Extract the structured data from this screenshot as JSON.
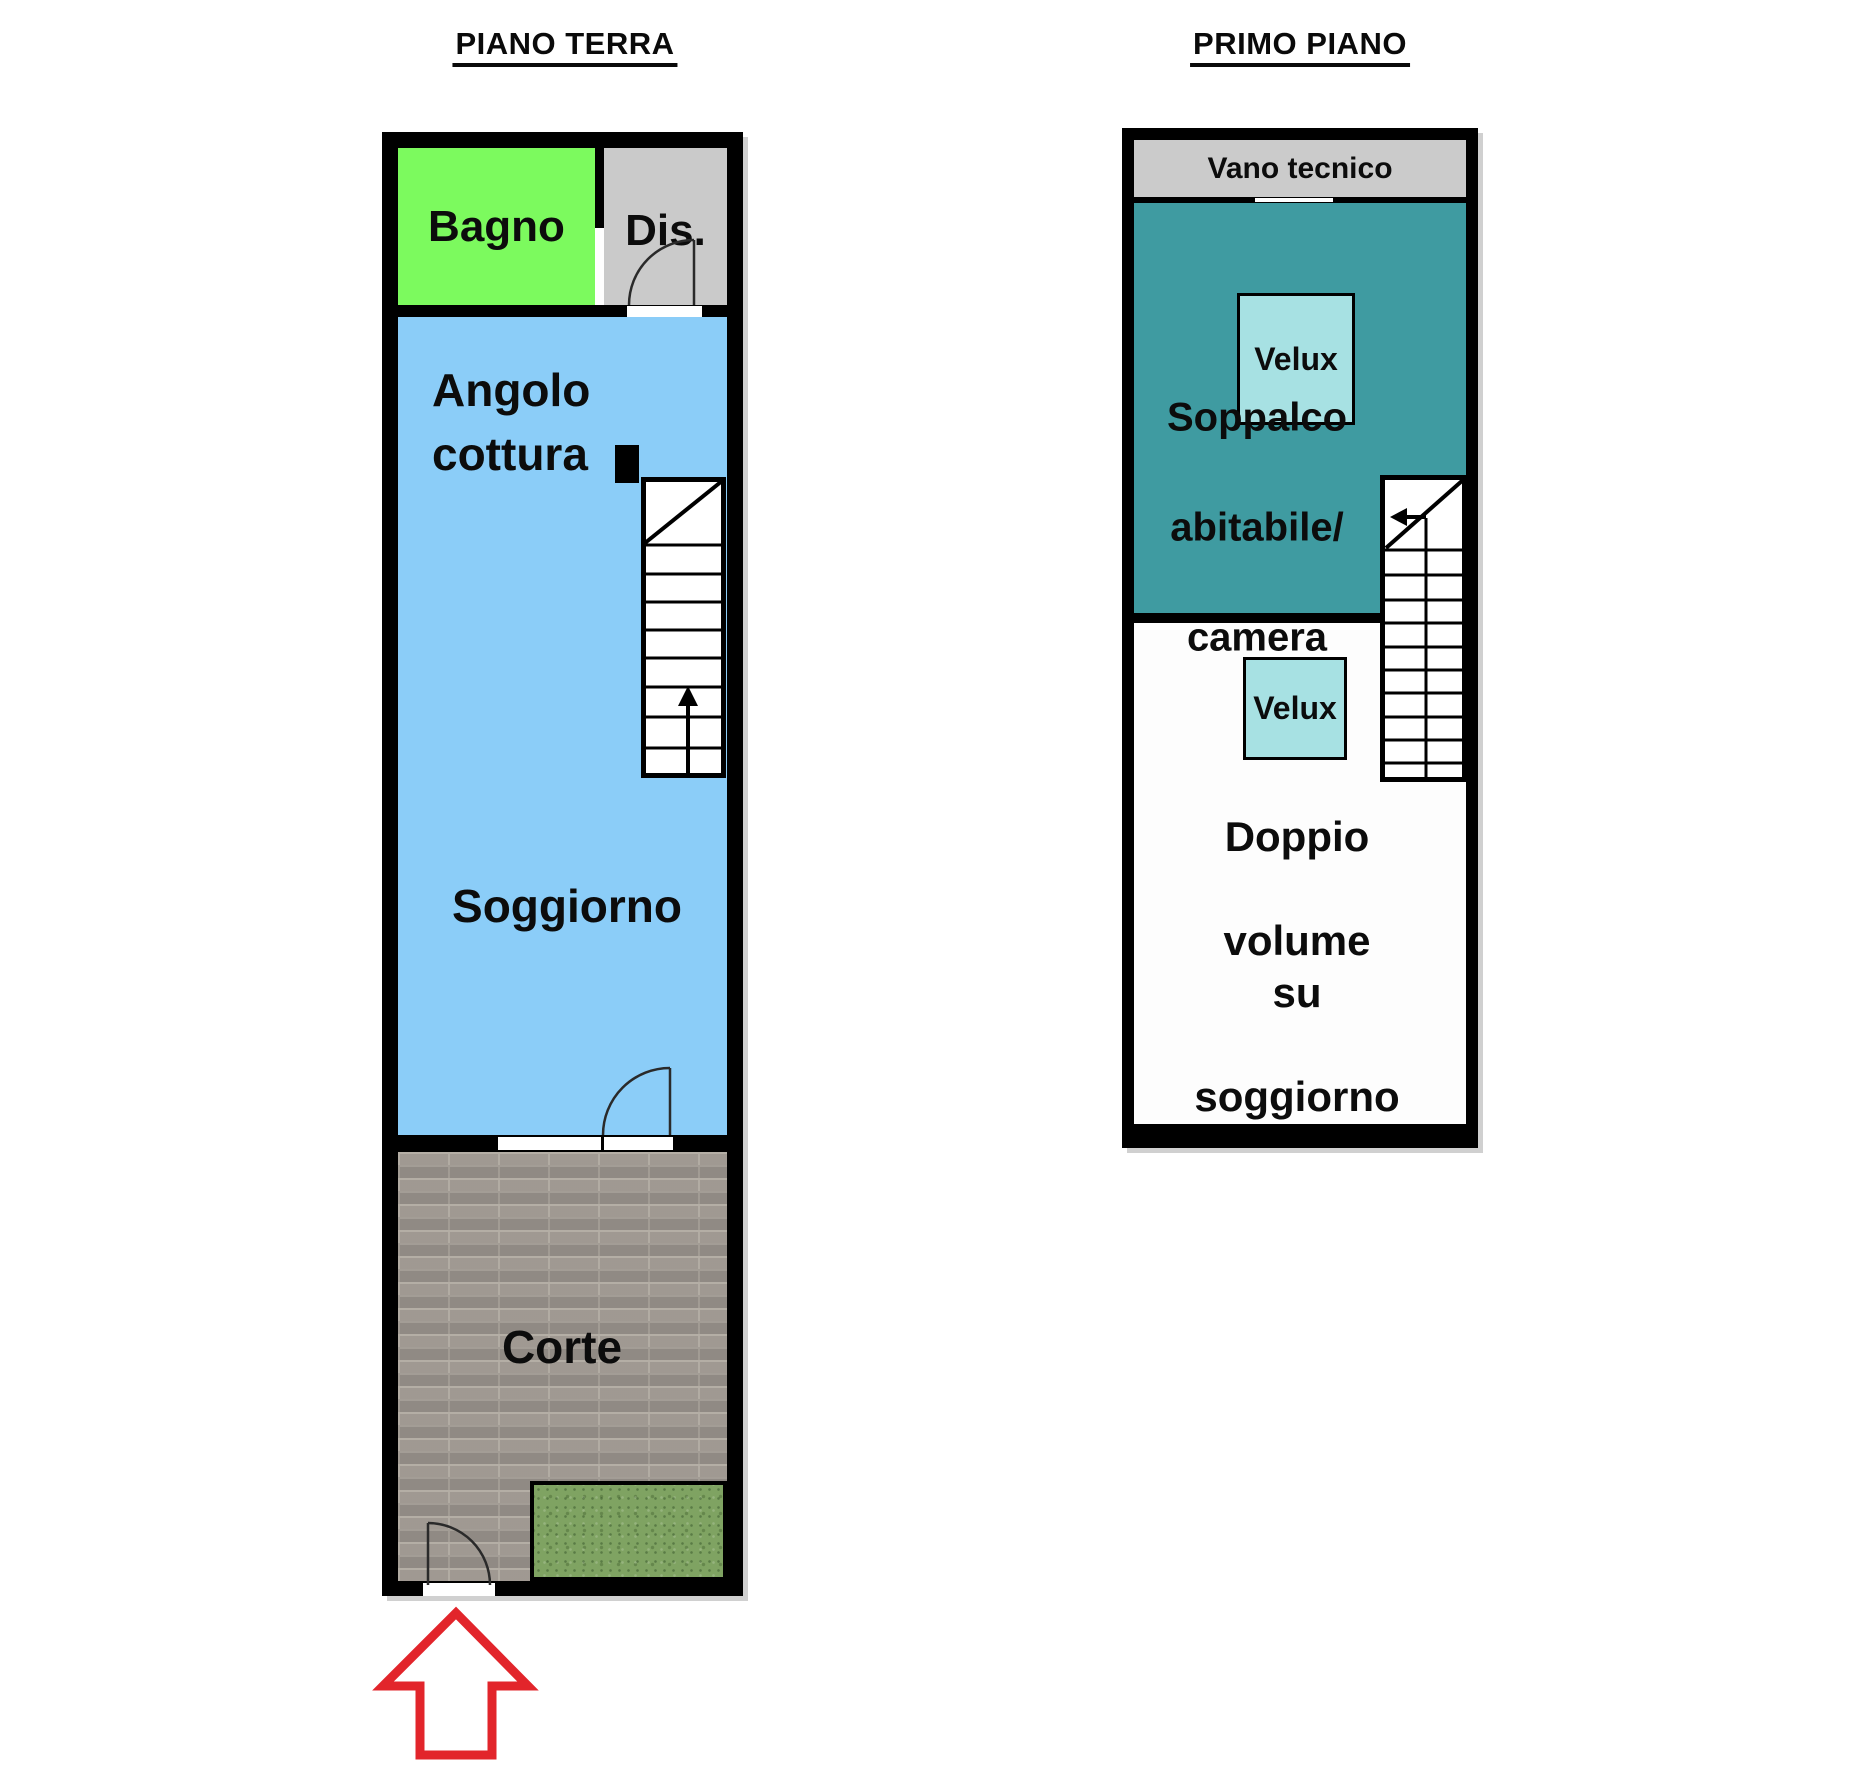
{
  "canvas": {
    "width": 1869,
    "height": 1791,
    "background": "#FFFFFF"
  },
  "wall_color": "#000000",
  "floors": [
    {
      "title": "PIANO TERRA",
      "rooms": {
        "bagno": {
          "label": "Bagno",
          "color": "#7CFA5E"
        },
        "dis": {
          "label": "Dis.",
          "color": "#CACACA"
        },
        "angolo_cottura": {
          "label": "Angolo cottura",
          "color": "#8BCDF8"
        },
        "soggiorno": {
          "label": "Soggiorno",
          "color": "#8BCDF8"
        },
        "corte": {
          "label": "Corte",
          "color": "#A8A19A"
        },
        "grass": {
          "color": "#7FA362"
        }
      },
      "icons": [
        "stairs-up-arrow-icon",
        "door-swing-icon",
        "window-opening",
        "entrance-arrow-icon"
      ]
    },
    {
      "title": "PRIMO PIANO",
      "rooms": {
        "vano_tecnico": {
          "label": "Vano tecnico",
          "color": "#CBCBCB"
        },
        "velux_top": {
          "label": "Velux",
          "color": "#A7E1E3"
        },
        "soppalco": {
          "lines": [
            "Soppalco",
            "abitabile/",
            "camera"
          ],
          "color": "#3F9BA1"
        },
        "velux_bottom": {
          "label": "Velux",
          "color": "#A7E1E3"
        },
        "doppio_volume": {
          "lines": [
            "Doppio",
            "volume su",
            "soggiorno"
          ],
          "color": "#FDFDFD"
        }
      },
      "icons": [
        "stairs-down-left-arrow-icon"
      ]
    }
  ],
  "entrance_arrow": {
    "color": "#E2252B"
  }
}
